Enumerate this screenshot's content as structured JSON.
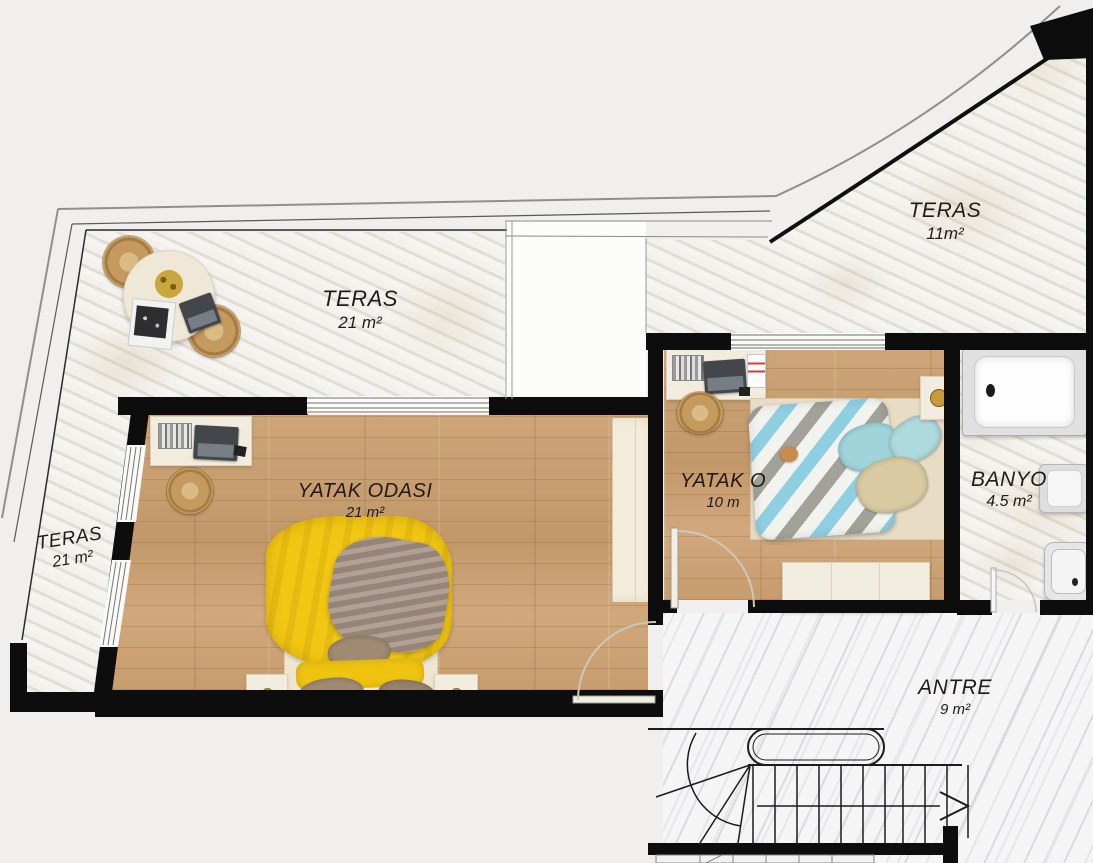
{
  "plan": {
    "title": "Floor plan – upper storey",
    "canvas": {
      "width": 1093,
      "height": 863
    },
    "rooms": [
      {
        "id": "teras-top",
        "name": "TERAS",
        "area": "21 m²"
      },
      {
        "id": "teras-upper-right",
        "name": "TERAS",
        "area": "11m²"
      },
      {
        "id": "teras-left",
        "name": "TERAS",
        "area": "21 m²"
      },
      {
        "id": "bedroom-main",
        "name": "YATAK ODASI",
        "area": "21 m²"
      },
      {
        "id": "bedroom-small",
        "name": "YATAK O",
        "area": "10 m"
      },
      {
        "id": "bathroom",
        "name": "BANYO",
        "area": "4.5 m²"
      },
      {
        "id": "entry-hall",
        "name": "ANTRE",
        "area": "9 m²"
      }
    ],
    "stairs": {
      "direction_arrow": "right"
    },
    "colors": {
      "background": "#f0efed",
      "wall": "#0d0d0d",
      "wood_floor": "#c89f72",
      "terrace_marble": "#e9e6e0",
      "entry_marble": "#f5f5f6",
      "bed_duvet_yellow": "#f1c713",
      "bed_blanket_taupe": "#a39184",
      "bed_chevron_teal": "#8ecfe2",
      "furniture_cream": "#f2ecdf",
      "rattan_tan": "#c59a5e"
    }
  }
}
